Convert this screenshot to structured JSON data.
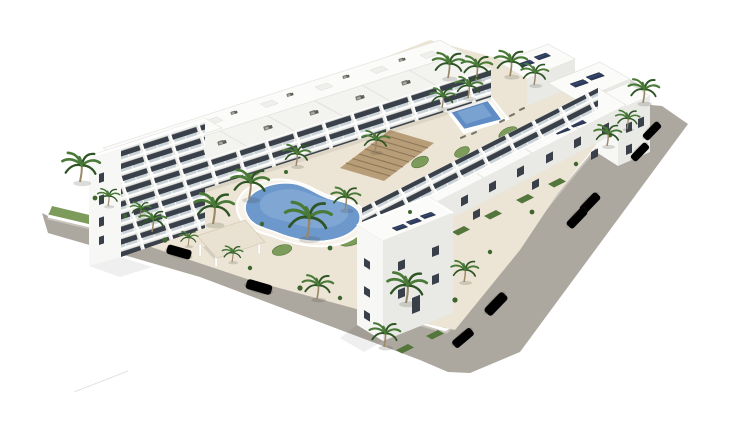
{
  "meta": {
    "type": "architectural-3d-render",
    "subject": "Aerial 3D rendering of a white Mediterranean-style apartment complex with a freeform lagoon pool, a small rectangular pool, roof terraces with furniture, solar panels, palm-tree gardens, perimeter roads and parked cars on a white background"
  },
  "colors": {
    "background": "#ffffff",
    "road": "#aca89f",
    "sidewalk": "#c8c4bc",
    "deck": "#ece4d4",
    "wall": "#ffffff",
    "grass": "#7d9c5b",
    "grassDark": "#54763c",
    "shrub": "#3f652f",
    "palmFrond": "#4a7a38",
    "palmFrondDark": "#2f5526",
    "palmTrunk": "#9a8768",
    "building": "#fbfbf9",
    "buildingLight": "#f3f3f0",
    "facade": "#e9e9e5",
    "buildingShade": "#d9d9d4",
    "glass": "#394049",
    "railing": "#c7d1d6",
    "timber": "#b79d78",
    "timberDark": "#8e7656",
    "poolWater": "#6d98cb",
    "poolWaterLight": "#8fb4dd",
    "poolRim": "#f7f3ea",
    "smallPool": "#5f8cc4",
    "solar": "#2c3a58",
    "solarLine": "#46588c",
    "furniture": "#76766f",
    "carDark": "#3d4045",
    "carSilver": "#c9cccd",
    "carWhite": "#ebebe9",
    "shadow": "rgba(60,60,55,0.18)"
  },
  "scene": {
    "counts": {
      "building_blocks": 7,
      "palm_trees": 25,
      "parked_cars": 8,
      "pools": 2,
      "solar_panel_groups": 4,
      "roof_terrace_furniture_sets": 16
    },
    "features": [
      "freeform-lagoon-pool",
      "rectangular-kids-pool",
      "timber-pergola-deck",
      "entrance-canopy",
      "perimeter-white-wall",
      "palm-garden-bands",
      "two-perimeter-roads"
    ]
  }
}
